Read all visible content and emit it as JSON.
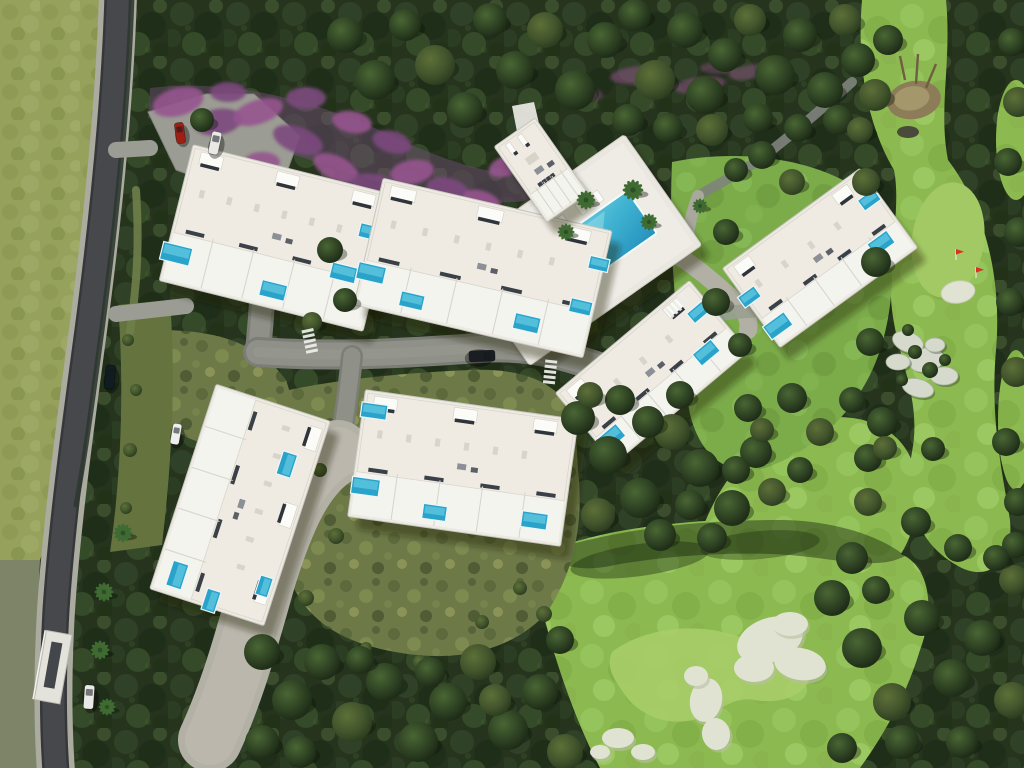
{
  "meta": {
    "type": "aerial-3d-render",
    "subject": "residential-resort-site-plan"
  },
  "palette": {
    "forest": "#2a3821",
    "forest_hi": "#42522f",
    "scrub": "#6d7947",
    "grass_left": "#96a15c",
    "grass_lower": "#7d8468",
    "fairway": "#8cba51",
    "fairway_light": "#a7cd68",
    "lawn": "#7cab4a",
    "asphalt": "#46484c",
    "sidewalk": "#abab9f",
    "paver": "#b3b1a5",
    "road_inner": "#8f9188",
    "building_body": "#f3f2ec",
    "roof": "#efebe2",
    "terrace": "#f4f4ef",
    "window_dark": "#2f343b",
    "pool_private": "#2aa3cb",
    "pool_light": "#5ec6dd",
    "deck": "#e9e7df",
    "sand": "#e0e3d2",
    "purple_a": "#7c4a7e",
    "purple_b": "#96548f",
    "pink": "#d4679e",
    "palm": "#3f6b33",
    "shadow": "rgba(20,30,14,0.38)",
    "car_red": "#9d1f16",
    "car_dark": "#11191c",
    "car_white": "#e9e9e6",
    "flag_red": "#d93025"
  },
  "scene": {
    "buildings": [
      {
        "id": "building-1",
        "cx": 278,
        "cy": 238,
        "w": 210,
        "h": 140,
        "rot": 14,
        "pools": [
          [
            -95,
            40,
            30,
            18
          ],
          [
            8,
            52,
            26,
            16
          ],
          [
            72,
            18,
            26,
            16
          ],
          [
            88,
            -28,
            22,
            14
          ]
        ]
      },
      {
        "id": "building-2",
        "cx": 483,
        "cy": 268,
        "w": 235,
        "h": 130,
        "rot": 13,
        "pools": [
          [
            -108,
            30,
            28,
            17
          ],
          [
            -62,
            48,
            24,
            15
          ],
          [
            55,
            44,
            26,
            16
          ],
          [
            104,
            16,
            22,
            14
          ],
          [
            112,
            -30,
            20,
            13
          ]
        ]
      },
      {
        "id": "building-3",
        "cx": 820,
        "cy": 258,
        "w": 170,
        "h": 98,
        "rot": -36,
        "pools": [
          [
            -74,
            30,
            26,
            16
          ],
          [
            -80,
            -10,
            20,
            13
          ],
          [
            58,
            24,
            24,
            15
          ],
          [
            74,
            -18,
            20,
            13
          ]
        ]
      },
      {
        "id": "building-4",
        "cx": 652,
        "cy": 372,
        "w": 175,
        "h": 92,
        "rot": -40,
        "pools": [
          [
            -74,
            24,
            26,
            16
          ],
          [
            54,
            20,
            24,
            15
          ],
          [
            74,
            -16,
            20,
            13
          ]
        ]
      },
      {
        "id": "building-5",
        "cx": 463,
        "cy": 468,
        "w": 215,
        "h": 128,
        "rot": 8,
        "pools": [
          [
            -96,
            -44,
            26,
            15
          ],
          [
            -94,
            32,
            28,
            17
          ],
          [
            -22,
            48,
            24,
            15
          ],
          [
            78,
            42,
            26,
            16
          ]
        ]
      },
      {
        "id": "building-6",
        "cx": 240,
        "cy": 505,
        "w": 215,
        "h": 120,
        "rot": 108,
        "pools": [
          [
            -53,
            -32,
            24,
            15
          ],
          [
            86,
            38,
            26,
            16
          ],
          [
            100,
            -2,
            22,
            14
          ],
          [
            70,
            -48,
            20,
            13
          ]
        ]
      },
      {
        "id": "clubhouse",
        "cx": 541,
        "cy": 170,
        "w": 50,
        "h": 92,
        "rot": -35,
        "pools": []
      }
    ],
    "community_pool": {
      "cx": 577,
      "cy": 250,
      "rot": -35,
      "deck_w": 210,
      "deck_h": 135,
      "pool_w": 150,
      "pool_h": 52,
      "lounger_rows": 2,
      "loungers_per_row": 6
    },
    "golf": {
      "green": {
        "cx": 948,
        "cy": 240,
        "rx": 36,
        "ry": 58,
        "rot": 8
      },
      "flags": [
        [
          956,
          260
        ],
        [
          976,
          278
        ]
      ],
      "green_bunker": [
        958,
        292,
        17,
        11,
        -10
      ],
      "rocks": [
        [
          908,
          342,
          16,
          10,
          20
        ],
        [
          926,
          360,
          18,
          12,
          -10
        ],
        [
          944,
          376,
          14,
          9,
          0
        ],
        [
          898,
          362,
          12,
          8,
          0
        ],
        [
          918,
          388,
          16,
          9,
          15
        ],
        [
          935,
          345,
          10,
          7,
          0
        ]
      ],
      "rock_shrubs": [
        [
          915,
          352,
          7
        ],
        [
          930,
          370,
          8
        ],
        [
          902,
          380,
          6
        ],
        [
          945,
          360,
          6
        ],
        [
          908,
          330,
          6
        ]
      ],
      "playground": {
        "cx": 914,
        "cy": 100
      }
    },
    "bunkers": [
      [
        770,
        640,
        34,
        22,
        -20
      ],
      [
        800,
        664,
        26,
        16,
        10
      ],
      [
        754,
        668,
        20,
        14,
        0
      ],
      [
        790,
        624,
        18,
        12,
        0
      ],
      [
        706,
        700,
        16,
        22,
        10
      ],
      [
        716,
        734,
        14,
        16,
        -10
      ],
      [
        696,
        676,
        12,
        10,
        0
      ],
      [
        618,
        738,
        16,
        10,
        0
      ],
      [
        643,
        752,
        12,
        8,
        0
      ],
      [
        600,
        752,
        10,
        7,
        0
      ]
    ],
    "purple_shrubs": [
      [
        178,
        102,
        26,
        14,
        -15
      ],
      [
        218,
        122,
        24,
        13,
        -10
      ],
      [
        258,
        112,
        26,
        12,
        -18
      ],
      [
        298,
        140,
        26,
        13,
        20
      ],
      [
        336,
        168,
        24,
        12,
        25
      ],
      [
        374,
        186,
        24,
        12,
        10
      ],
      [
        412,
        172,
        22,
        12,
        -10
      ],
      [
        448,
        190,
        22,
        12,
        15
      ],
      [
        482,
        202,
        20,
        11,
        20
      ],
      [
        306,
        98,
        20,
        11,
        0
      ],
      [
        352,
        122,
        20,
        11,
        10
      ],
      [
        392,
        142,
        20,
        11,
        15
      ],
      [
        262,
        162,
        18,
        10,
        0
      ],
      [
        228,
        92,
        18,
        10,
        0
      ],
      [
        506,
        166,
        18,
        10,
        -20
      ],
      [
        528,
        148,
        16,
        9,
        -25
      ],
      [
        338,
        225,
        16,
        10,
        0
      ]
    ],
    "forest_purple": [
      [
        640,
        75,
        30,
        9,
        -5,
        0.5
      ],
      [
        700,
        85,
        26,
        8,
        -8,
        0.5
      ],
      [
        750,
        72,
        22,
        7,
        -10,
        0.45
      ],
      [
        585,
        95,
        18,
        7,
        0,
        0.4
      ],
      [
        718,
        68,
        18,
        6,
        0,
        0.4
      ]
    ],
    "pink_shrubs": [
      [
        586,
        142,
        16,
        9,
        -20
      ],
      [
        610,
        158,
        14,
        8,
        -10
      ],
      [
        686,
        162,
        16,
        10,
        0
      ],
      [
        700,
        185,
        13,
        8,
        0
      ],
      [
        474,
        182,
        14,
        8,
        -30
      ],
      [
        498,
        166,
        13,
        8,
        -30
      ],
      [
        524,
        289,
        14,
        7,
        -35
      ],
      [
        548,
        306,
        14,
        7,
        -35
      ],
      [
        572,
        322,
        14,
        7,
        -35
      ],
      [
        600,
        334,
        13,
        7,
        -30
      ],
      [
        462,
        262,
        12,
        7,
        -35
      ],
      [
        486,
        278,
        12,
        7,
        -35
      ]
    ],
    "olive_shrubs": [
      [
        320,
        470,
        7
      ],
      [
        336,
        536,
        8
      ],
      [
        306,
        598,
        8
      ],
      [
        520,
        588,
        7
      ],
      [
        544,
        614,
        8
      ],
      [
        482,
        622,
        7
      ],
      [
        128,
        340,
        6
      ],
      [
        136,
        390,
        6
      ],
      [
        130,
        450,
        7
      ],
      [
        126,
        508,
        6
      ],
      [
        250,
        420,
        6
      ],
      [
        262,
        448,
        5
      ],
      [
        420,
        662,
        7
      ],
      [
        366,
        648,
        6
      ],
      [
        560,
        640,
        7
      ]
    ],
    "trees": [
      [
        345,
        35,
        18
      ],
      [
        375,
        80,
        20
      ],
      [
        405,
        25,
        16
      ],
      [
        435,
        65,
        20
      ],
      [
        465,
        110,
        18
      ],
      [
        490,
        20,
        17
      ],
      [
        515,
        70,
        19
      ],
      [
        545,
        30,
        18
      ],
      [
        575,
        90,
        20
      ],
      [
        605,
        40,
        18
      ],
      [
        635,
        15,
        16
      ],
      [
        655,
        80,
        20
      ],
      [
        685,
        30,
        18
      ],
      [
        705,
        95,
        19
      ],
      [
        725,
        55,
        17
      ],
      [
        750,
        20,
        16
      ],
      [
        775,
        75,
        20
      ],
      [
        800,
        35,
        17
      ],
      [
        825,
        90,
        18
      ],
      [
        845,
        20,
        16
      ],
      [
        858,
        60,
        17
      ],
      [
        628,
        120,
        16
      ],
      [
        668,
        128,
        15
      ],
      [
        712,
        130,
        16
      ],
      [
        758,
        118,
        15
      ],
      [
        798,
        128,
        14
      ],
      [
        838,
        120,
        15
      ],
      [
        875,
        95,
        16
      ],
      [
        888,
        40,
        15
      ],
      [
        202,
        120,
        12
      ],
      [
        762,
        155,
        14
      ],
      [
        792,
        182,
        13
      ],
      [
        736,
        170,
        12
      ],
      [
        330,
        250,
        13
      ],
      [
        345,
        300,
        12
      ],
      [
        312,
        322,
        10
      ],
      [
        578,
        418,
        17
      ],
      [
        608,
        455,
        19
      ],
      [
        640,
        498,
        20
      ],
      [
        672,
        432,
        18
      ],
      [
        700,
        468,
        19
      ],
      [
        732,
        508,
        18
      ],
      [
        756,
        452,
        16
      ],
      [
        598,
        515,
        17
      ],
      [
        660,
        535,
        16
      ],
      [
        712,
        538,
        15
      ],
      [
        748,
        408,
        14
      ],
      [
        772,
        492,
        14
      ],
      [
        620,
        400,
        15
      ],
      [
        648,
        422,
        16
      ],
      [
        680,
        395,
        14
      ],
      [
        590,
        395,
        13
      ],
      [
        736,
        470,
        14
      ],
      [
        690,
        505,
        15
      ],
      [
        792,
        398,
        15
      ],
      [
        820,
        432,
        14
      ],
      [
        852,
        400,
        13
      ],
      [
        868,
        458,
        14
      ],
      [
        800,
        470,
        13
      ],
      [
        762,
        430,
        12
      ],
      [
        262,
        652,
        18
      ],
      [
        292,
        700,
        20
      ],
      [
        322,
        662,
        18
      ],
      [
        352,
        722,
        20
      ],
      [
        385,
        682,
        19
      ],
      [
        418,
        742,
        20
      ],
      [
        448,
        702,
        19
      ],
      [
        478,
        662,
        18
      ],
      [
        508,
        730,
        20
      ],
      [
        540,
        692,
        18
      ],
      [
        262,
        742,
        17
      ],
      [
        565,
        752,
        18
      ],
      [
        300,
        752,
        16
      ],
      [
        360,
        660,
        14
      ],
      [
        430,
        672,
        15
      ],
      [
        495,
        700,
        16
      ],
      [
        560,
        640,
        14
      ],
      [
        832,
        598,
        18
      ],
      [
        862,
        648,
        20
      ],
      [
        892,
        702,
        19
      ],
      [
        922,
        618,
        18
      ],
      [
        952,
        678,
        19
      ],
      [
        982,
        638,
        18
      ],
      [
        1012,
        700,
        18
      ],
      [
        852,
        558,
        16
      ],
      [
        902,
        742,
        17
      ],
      [
        962,
        742,
        16
      ],
      [
        1014,
        580,
        15
      ],
      [
        842,
        748,
        15
      ],
      [
        876,
        590,
        14
      ],
      [
        1012,
        42,
        14
      ],
      [
        1018,
        102,
        15
      ],
      [
        1008,
        162,
        14
      ],
      [
        1019,
        232,
        15
      ],
      [
        1010,
        302,
        14
      ],
      [
        1016,
        372,
        15
      ],
      [
        1006,
        442,
        14
      ],
      [
        1018,
        502,
        14
      ],
      [
        1015,
        545,
        13
      ],
      [
        866,
        182,
        14
      ],
      [
        876,
        262,
        15
      ],
      [
        870,
        342,
        14
      ],
      [
        882,
        422,
        15
      ],
      [
        868,
        502,
        14
      ],
      [
        916,
        522,
        15
      ],
      [
        958,
        548,
        14
      ],
      [
        996,
        558,
        13
      ],
      [
        860,
        130,
        13
      ],
      [
        726,
        232,
        13
      ],
      [
        716,
        302,
        14
      ],
      [
        740,
        345,
        12
      ],
      [
        885,
        448,
        12
      ],
      [
        933,
        449,
        12
      ]
    ],
    "palms": [
      [
        123,
        533,
        1
      ],
      [
        104,
        592,
        1
      ],
      [
        100,
        650,
        1
      ],
      [
        107,
        707,
        0.9
      ],
      [
        633,
        190,
        1.1
      ],
      [
        586,
        200,
        1
      ],
      [
        566,
        232,
        0.9
      ],
      [
        649,
        222,
        0.9
      ],
      [
        700,
        206,
        0.8
      ]
    ],
    "cars": [
      {
        "id": "car-red-parking",
        "color": "#9d1f16",
        "x": 180,
        "y": 133,
        "w": 9,
        "l": 21,
        "rot": -8
      },
      {
        "id": "van-white-parking",
        "color": "#e9e9e6",
        "x": 215,
        "y": 143,
        "w": 10,
        "l": 23,
        "rot": 12
      },
      {
        "id": "car-dark-road",
        "color": "#0f1d20",
        "x": 110,
        "y": 377,
        "w": 10,
        "l": 24,
        "rot": 6
      },
      {
        "id": "car-white-drive",
        "color": "#eeeeec",
        "x": 176,
        "y": 434,
        "w": 9,
        "l": 21,
        "rot": 10
      },
      {
        "id": "car-dark-central",
        "color": "#1a1d22",
        "x": 482,
        "y": 356,
        "w": 11,
        "l": 26,
        "rot": 88
      },
      {
        "id": "van-white-plaza",
        "color": "#e9e9e7",
        "x": 89,
        "y": 697,
        "w": 10,
        "l": 24,
        "rot": 4
      }
    ],
    "crosswalks": [
      [
        310,
        342,
        78
      ],
      [
        550,
        373,
        96
      ],
      [
        678,
        305,
        -42
      ]
    ]
  }
}
